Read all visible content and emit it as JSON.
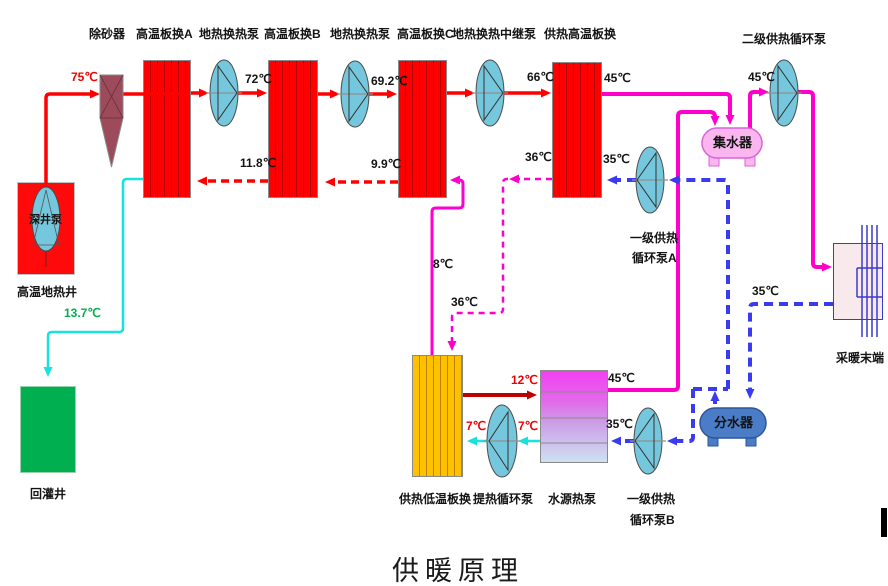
{
  "title": "供暖原理",
  "colors": {
    "geothermal_supply_line": "#ff0000",
    "geothermal_return_line_dashed": "#ff0000",
    "heating_supply_line": "#ff00cc",
    "heating_return_line_dashed": "#3a3aef",
    "reinjection_line": "#17e2dc",
    "low_temp_supply_line": "#c00000",
    "reinjection_label": "#00b050",
    "exchanger_fill": "#ff0000",
    "low_temp_exchanger_fill": "#ffc000",
    "collector_fill": "#fbb6f0",
    "distributor_fill": "#4a7cc7",
    "pump_fill": "#74c7dc",
    "sand_remover_fill": "#9d4b5b",
    "reinjection_well_fill": "#00b050"
  },
  "components": {
    "sand_remover": "除砂器",
    "hx_a": "高温板换A",
    "geo_pump_1": "地热换热泵",
    "hx_b": "高温板换B",
    "geo_pump_2": "地热换热泵",
    "hx_c": "高温板换C",
    "geo_relay_pump": "地热换热中继泵",
    "heating_ht_hx": "供热高温板换",
    "secondary_heating_pump": "二级供热循环泵",
    "deep_well_pump": "深井泵",
    "ht_geothermal_well": "高温地热井",
    "reinjection_well": "回灌井",
    "water_collector": "集水器",
    "water_distributor": "分水器",
    "primary_pump_a_line1": "一级供热",
    "primary_pump_a_line2": "循环泵A",
    "primary_pump_b_line1": "一级供热",
    "primary_pump_b_line2": "循环泵B",
    "heating_lt_hx": "供热低温板换",
    "heat_extraction_pump": "提热循环泵",
    "water_source_heat_pump": "水源热泵",
    "heating_terminal": "采暖末端"
  },
  "temperatures": {
    "well_supply": "75℃",
    "after_hx_a": "72℃",
    "after_hx_b": "69.2℃",
    "after_hx_c": "66℃",
    "return_to_hx_a": "11.8℃",
    "return_to_hx_b": "9.9℃",
    "reinjection": "13.7℃",
    "ht_hx_supply_out": "45℃",
    "to_secondary_pump": "45℃",
    "ht_hx_return_out": "36℃",
    "ht_hx_return_in": "35℃",
    "to_hx_c": "8℃",
    "to_lt_hx": "36℃",
    "lt_hx_out": "12℃",
    "lt_hx_in_after_pump": "7℃",
    "lt_hx_in_before_pump": "7℃",
    "wshp_supply_out": "45℃",
    "wshp_return_in": "35℃",
    "terminal_return": "35℃"
  }
}
